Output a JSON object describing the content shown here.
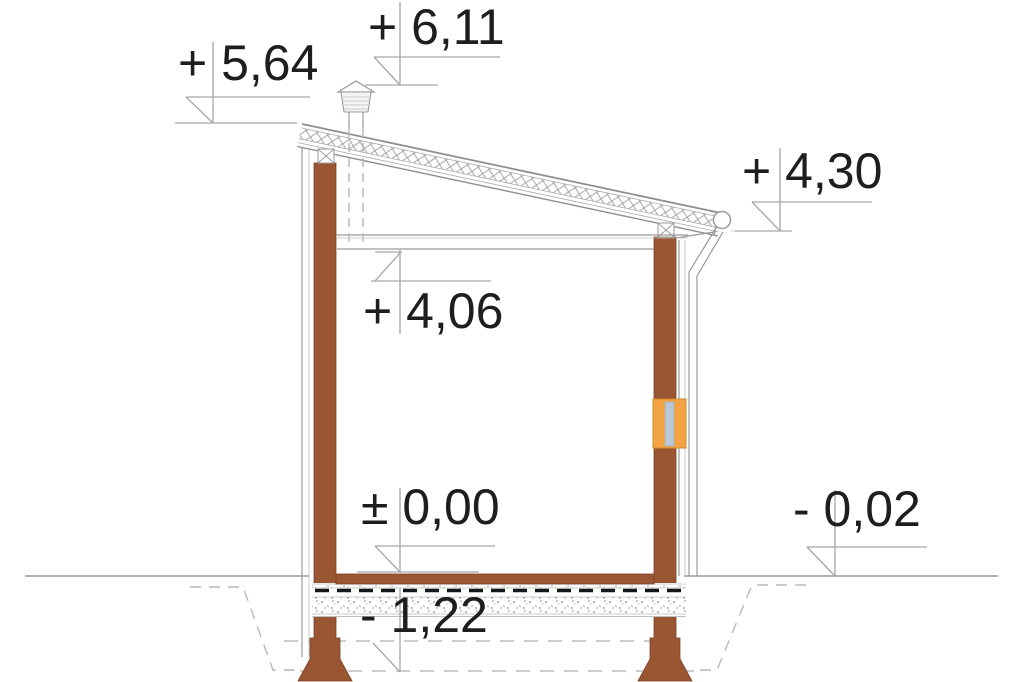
{
  "levels": [
    {
      "name": "chimney-top",
      "label": "+ 6,11"
    },
    {
      "name": "roof-high-edge",
      "label": "+ 5,64"
    },
    {
      "name": "eaves-gutter",
      "label": "+ 4,30"
    },
    {
      "name": "ceiling-underside",
      "label": "+ 4,06"
    },
    {
      "name": "finished-floor",
      "label": "± 0,00"
    },
    {
      "name": "exterior-ground",
      "label": "- 0,02"
    },
    {
      "name": "foundation-bottom",
      "label": "- 1,22"
    }
  ],
  "colors": {
    "wood_brown": "#9a5632",
    "window_orange": "#f2a444",
    "glass_blue": "#b9c7d6",
    "drawing_line_gray": "#9a9a9a",
    "label_text": "#1e1e1e"
  }
}
